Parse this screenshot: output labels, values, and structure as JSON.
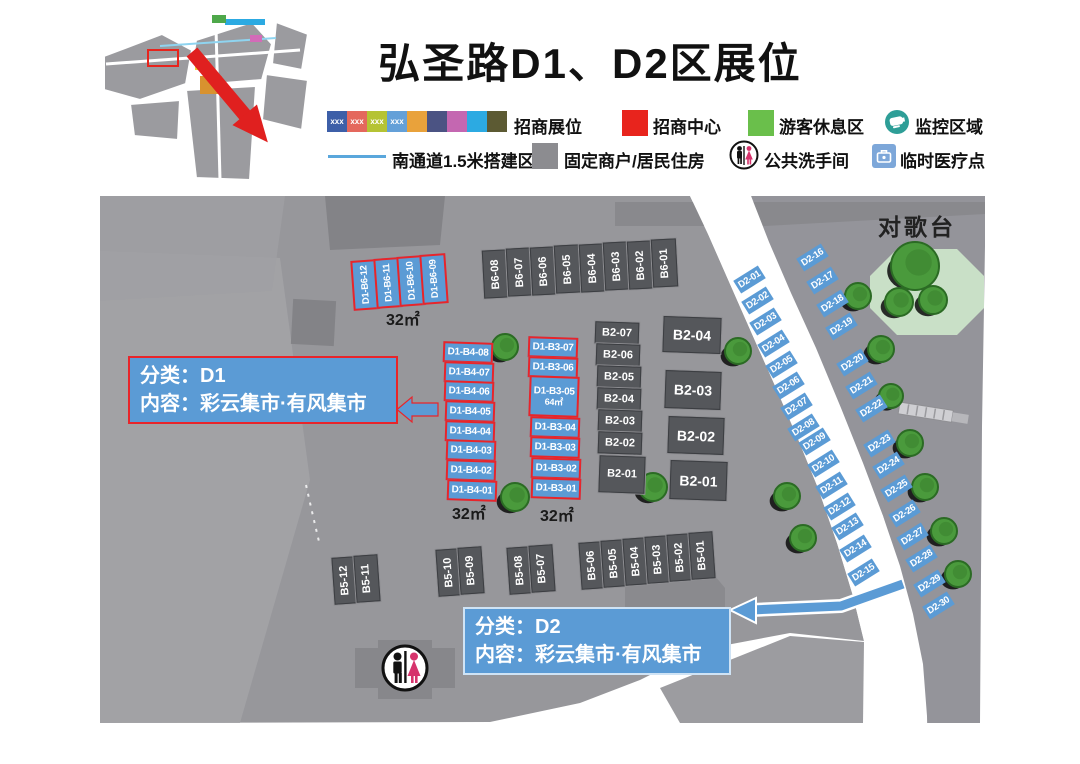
{
  "title": "弘圣路D1、D2区展位",
  "legend": {
    "swatch_text": "xxx",
    "swatch_colors": [
      "#3d5fa8",
      "#e4685d",
      "#b5c334",
      "#64a0d8",
      "#e9a23b",
      "#4b5383",
      "#c467b1",
      "#2caae2",
      "#5c5a33"
    ],
    "booths_label": "招商展位",
    "center_label": "招商中心",
    "rest_label": "游客休息区",
    "monitor_label": "监控区域",
    "channel_label": "南通道1.5米搭建区",
    "fixed_label": "固定商户/居民住房",
    "wc_label": "公共洗手间",
    "medical_label": "临时医疗点",
    "colors": {
      "center": "#e8241d",
      "rest": "#6abf4b",
      "fixed": "#8c8c90",
      "monitor": "#2e9e97",
      "medical": "#7da7d9",
      "channel_line": "#5aa7dc",
      "booth_blue": "#5b9bd5",
      "booth_red_border": "#e8252a"
    }
  },
  "map": {
    "stage_label": "对歌台",
    "area_labels": {
      "d1b6": "32㎡",
      "d1b4": "32㎡",
      "d1b3": "32㎡",
      "d1b3_05": "64㎡"
    },
    "class_d1": {
      "line1": "分类：D1",
      "line2": "内容：彩云集市·有风集市"
    },
    "class_d2": {
      "line1": "分类：D2",
      "line2": "内容：彩云集市·有风集市"
    },
    "booths": {
      "d1_b6": [
        "D1-B6-12",
        "D1-B6-11",
        "D1-B6-10",
        "D1-B6-09"
      ],
      "b6": [
        "B6-08",
        "B6-07",
        "B6-06",
        "B6-05",
        "B6-04",
        "B6-03",
        "B6-02",
        "B6-01"
      ],
      "d1_b4": [
        "D1-B4-08",
        "D1-B4-07",
        "D1-B4-06",
        "D1-B4-05",
        "D1-B4-04",
        "D1-B4-03",
        "D1-B4-02",
        "D1-B4-01"
      ],
      "d1_b3": [
        "D1-B3-07",
        "D1-B3-06",
        "D1-B3-05",
        "D1-B3-04",
        "D1-B3-03",
        "D1-B3-02",
        "D1-B3-01"
      ],
      "b2_small": [
        "B2-07",
        "B2-06",
        "B2-05",
        "B2-04",
        "B2-03",
        "B2-02",
        "B2-01"
      ],
      "b2_large": [
        "B2-04",
        "B2-03",
        "B2-02",
        "B2-01"
      ],
      "b5": [
        "B5-12",
        "B5-11",
        "B5-10",
        "B5-09",
        "B5-08",
        "B5-07",
        "B5-06",
        "B5-05",
        "B5-04",
        "B5-03",
        "B5-02",
        "B5-01"
      ],
      "d2": [
        "D2-01",
        "D2-02",
        "D2-03",
        "D2-04",
        "D2-05",
        "D2-06",
        "D2-07",
        "D2-08",
        "D2-09",
        "D2-10",
        "D2-11",
        "D2-12",
        "D2-13",
        "D2-14",
        "D2-15",
        "D2-16",
        "D2-17",
        "D2-18",
        "D2-19",
        "D2-20",
        "D2-21",
        "D2-22",
        "D2-23",
        "D2-24",
        "D2-25",
        "D2-26",
        "D2-27",
        "D2-28",
        "D2-29",
        "D2-30"
      ]
    }
  }
}
